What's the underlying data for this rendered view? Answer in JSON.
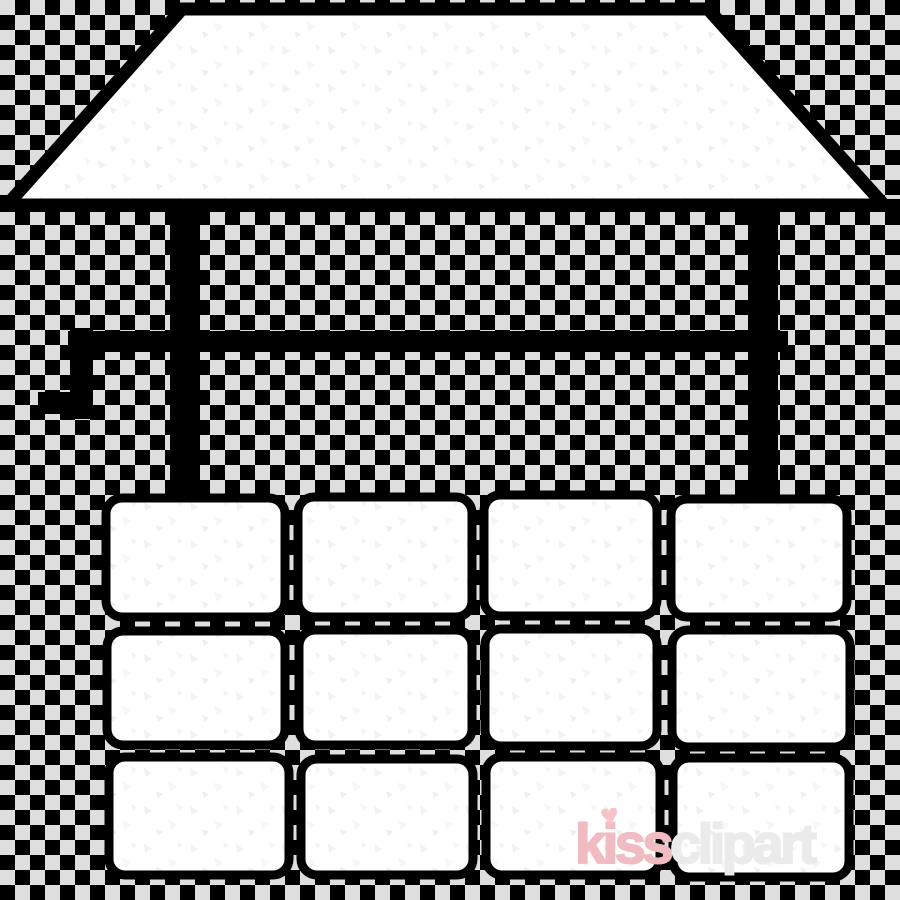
{
  "canvas": {
    "width": 900,
    "height": 900
  },
  "background": {
    "name": "transparency-checkerboard",
    "checker_dark": "#000000",
    "checker_light": "#dedede",
    "square_size_px": 15
  },
  "illustration": {
    "name": "water-well-line-art",
    "subject": "wishing well with roof, support posts, crank axle and stone brick base",
    "stroke_color": "#000000",
    "fill_color": "#ffffff",
    "speckle_color": "#f2f2f2",
    "brick_rows": 3,
    "brick_columns": 4
  },
  "watermark": {
    "brand_prefix": "kiss",
    "brand_suffix": "clipart",
    "heart_icon": "heart",
    "heart_glyph": "♥",
    "prefix_color": "#f0bcc1",
    "suffix_color": "#ebebeb",
    "heart_color": "#f5c3c9"
  }
}
